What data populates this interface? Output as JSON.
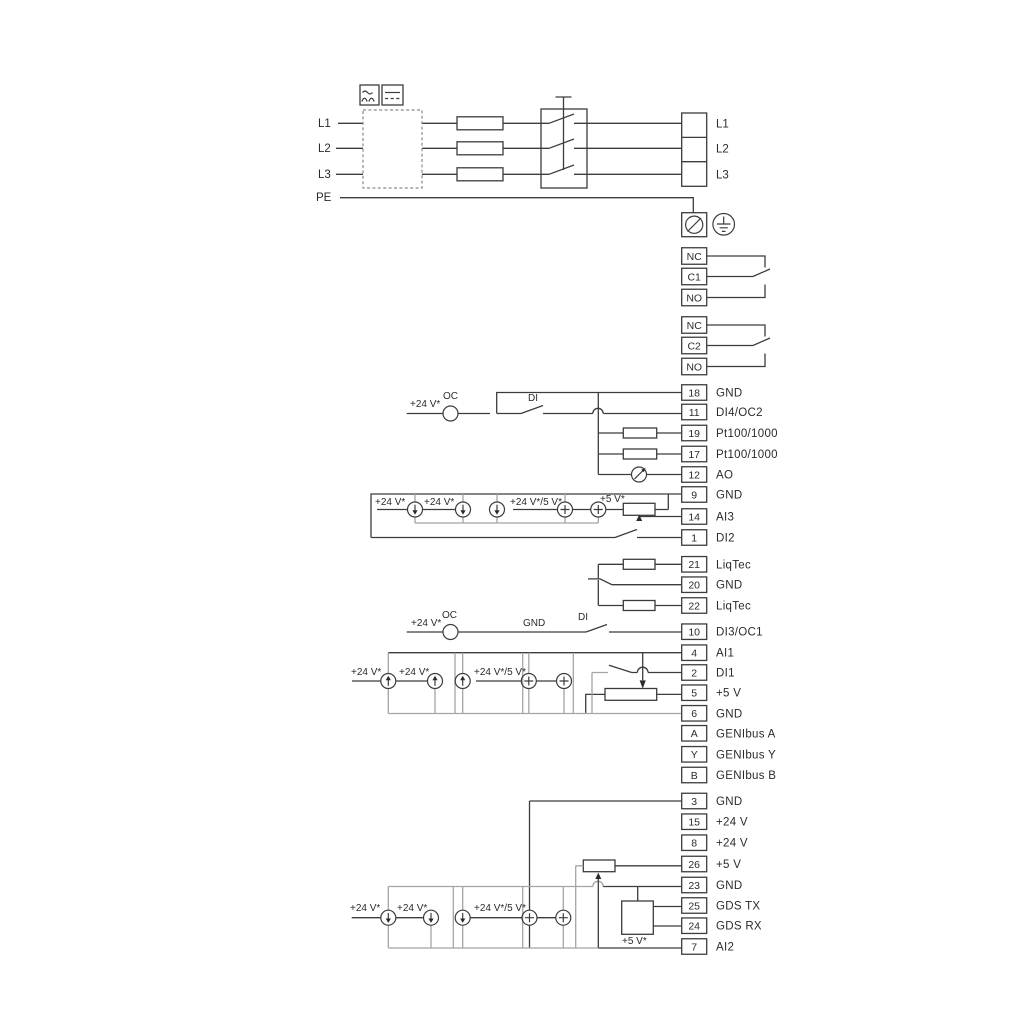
{
  "diagram": {
    "title": "pump-power-and-control-terminal-wiring-diagram",
    "colors": {
      "wire": "#3c3c3c",
      "option_frame": "#a5a5a5",
      "text": "#2b2b2b"
    },
    "mains": {
      "input_labels": [
        {
          "text": "L1",
          "x": 318,
          "y": 127
        },
        {
          "text": "L2",
          "x": 318,
          "y": 152
        },
        {
          "text": "L3",
          "x": 318,
          "y": 178
        },
        {
          "text": "PE",
          "x": 316,
          "y": 201
        }
      ],
      "output_terminals": [
        {
          "text": "L1",
          "y": 123.3
        },
        {
          "text": "L2",
          "y": 148.3
        },
        {
          "text": "L3",
          "y": 174.3
        }
      ]
    },
    "relays": [
      {
        "terminals": [
          {
            "id": "NC",
            "y": 256
          },
          {
            "id": "C1",
            "y": 276.5
          },
          {
            "id": "NO",
            "y": 297.5
          }
        ]
      },
      {
        "terminals": [
          {
            "id": "NC",
            "y": 325
          },
          {
            "id": "C2",
            "y": 345.5
          },
          {
            "id": "NO",
            "y": 366.5
          }
        ]
      }
    ],
    "io_terminals": [
      {
        "id": "18",
        "label": "GND",
        "y": 392.5
      },
      {
        "id": "11",
        "label": "DI4/OC2",
        "y": 412
      },
      {
        "id": "19",
        "label": "Pt100/1000",
        "y": 433
      },
      {
        "id": "17",
        "label": "Pt100/1000",
        "y": 454
      },
      {
        "id": "12",
        "label": "AO",
        "y": 474.5
      },
      {
        "id": "9",
        "label": "GND",
        "y": 494.5
      },
      {
        "id": "14",
        "label": "AI3",
        "y": 516.5
      },
      {
        "id": "1",
        "label": "DI2",
        "y": 537.5
      },
      {
        "id": "21",
        "label": "LiqTec",
        "y": 564.3
      },
      {
        "id": "20",
        "label": "GND",
        "y": 584.7
      },
      {
        "id": "22",
        "label": "LiqTec",
        "y": 605.5
      },
      {
        "id": "10",
        "label": "DI3/OC1",
        "y": 631.7
      },
      {
        "id": "4",
        "label": "AI1",
        "y": 652.7
      },
      {
        "id": "2",
        "label": "DI1",
        "y": 672.5
      },
      {
        "id": "5",
        "label": "+5 V",
        "y": 692.7
      },
      {
        "id": "6",
        "label": "GND",
        "y": 713.3
      },
      {
        "id": "A",
        "label": "GENIbus A",
        "y": 733.3
      },
      {
        "id": "Y",
        "label": "GENIbus Y",
        "y": 754.3
      },
      {
        "id": "B",
        "label": "GENIbus B",
        "y": 775
      },
      {
        "id": "3",
        "label": "GND",
        "y": 801
      },
      {
        "id": "15",
        "label": "+24 V",
        "y": 821.7
      },
      {
        "id": "8",
        "label": "+24 V",
        "y": 842.7
      },
      {
        "id": "26",
        "label": "+5 V",
        "y": 864
      },
      {
        "id": "23",
        "label": "GND",
        "y": 885
      },
      {
        "id": "25",
        "label": "GDS TX",
        "y": 905.5
      },
      {
        "id": "24",
        "label": "GDS RX",
        "y": 925.7
      },
      {
        "id": "7",
        "label": "AI2",
        "y": 946.5
      }
    ],
    "annotations": [
      {
        "text": "+24 V*",
        "x": 410,
        "y": 407
      },
      {
        "text": "OC",
        "x": 443,
        "y": 399
      },
      {
        "text": "DI",
        "x": 528,
        "y": 401
      },
      {
        "text": "+24 V*",
        "x": 375,
        "y": 505
      },
      {
        "text": "+24 V*",
        "x": 424,
        "y": 505
      },
      {
        "text": "+24 V*/5 V*",
        "x": 510,
        "y": 505
      },
      {
        "text": "+5 V*",
        "x": 600,
        "y": 502
      },
      {
        "text": "+24 V*",
        "x": 411,
        "y": 626
      },
      {
        "text": "OC",
        "x": 442,
        "y": 618
      },
      {
        "text": "GND",
        "x": 523,
        "y": 626
      },
      {
        "text": "DI",
        "x": 578,
        "y": 620
      },
      {
        "text": "+24 V*",
        "x": 351,
        "y": 675
      },
      {
        "text": "+24 V*",
        "x": 399,
        "y": 675
      },
      {
        "text": "+24 V*/5 V*",
        "x": 474,
        "y": 675
      },
      {
        "text": "+24 V*",
        "x": 350,
        "y": 911
      },
      {
        "text": "+24 V*",
        "x": 397,
        "y": 911
      },
      {
        "text": "+24 V*/5 V*",
        "x": 474,
        "y": 911
      },
      {
        "text": "+5 V*",
        "x": 622,
        "y": 944
      }
    ]
  }
}
